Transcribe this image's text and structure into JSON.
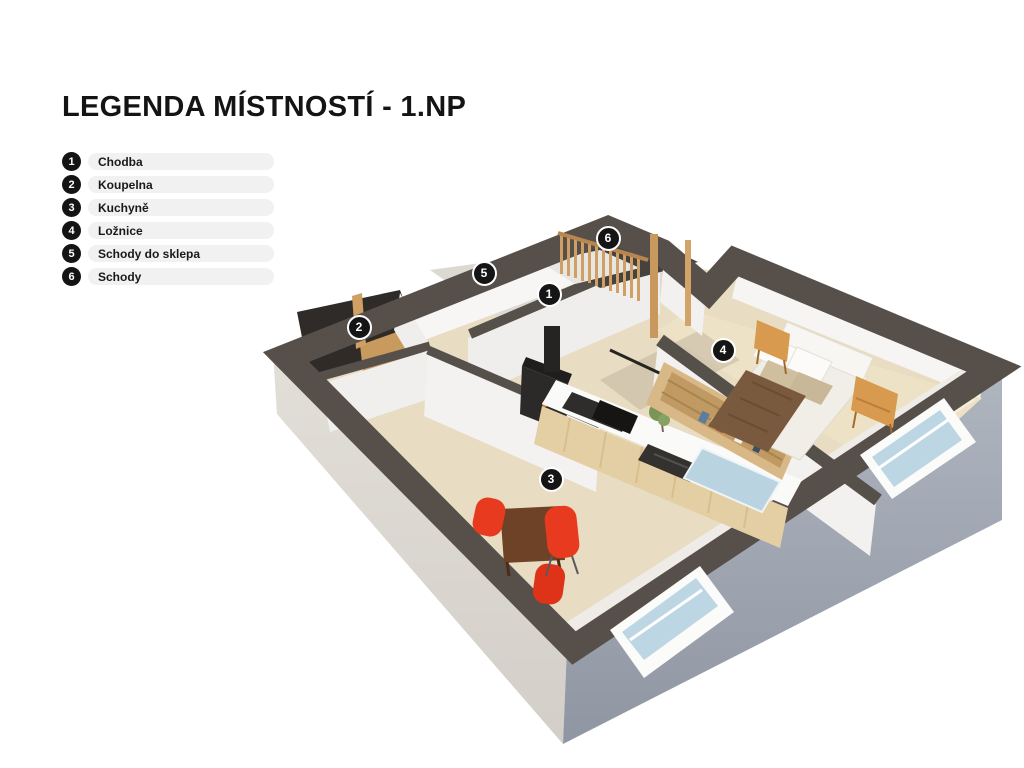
{
  "title": "LEGENDA MÍSTNOSTÍ - 1.NP",
  "legend": {
    "items": [
      {
        "number": "1",
        "label": "Chodba"
      },
      {
        "number": "2",
        "label": "Koupelna"
      },
      {
        "number": "3",
        "label": "Kuchyně"
      },
      {
        "number": "4",
        "label": "Ložnice"
      },
      {
        "number": "5",
        "label": "Schody do sklepa"
      },
      {
        "number": "6",
        "label": "Schody"
      }
    ]
  },
  "floorplan": {
    "markers": [
      {
        "number": "1",
        "label": "Chodba",
        "x": 549,
        "y": 294
      },
      {
        "number": "2",
        "label": "Koupelna",
        "x": 359,
        "y": 327
      },
      {
        "number": "3",
        "label": "Kuchyně",
        "x": 551,
        "y": 479
      },
      {
        "number": "4",
        "label": "Ložnice",
        "x": 723,
        "y": 350
      },
      {
        "number": "5",
        "label": "Schody do sklepa",
        "x": 484,
        "y": 273
      },
      {
        "number": "6",
        "label": "Schody",
        "x": 608,
        "y": 238
      }
    ],
    "palette": {
      "wall_top_band": "#57504a",
      "outer_wall_left": "#dcd8d2",
      "outer_wall_right": "#a2a9b4",
      "inner_wall_white": "#f4f3f1",
      "floor_wood": "#e8dcc2",
      "floor_pale": "#eee2c6",
      "floor_shadow": "#9e968a",
      "wood_partition": "#cf9f63",
      "island_wood": "#e4cfa5",
      "bathroom_dark": "#2e2b29",
      "stove_black": "#2c2a28",
      "bed_linen": "#f1eee7",
      "blanket_brown": "#7a5a3e",
      "pillow_beige": "#cfbf9f",
      "nightstand_orange": "#d89a4f",
      "chair_red": "#e73a1e",
      "table_wood": "#6e4226",
      "glass_blue": "#b9d3e1",
      "plant_green": "#7b9558",
      "marker_bg": "#151515",
      "legend_pill_bg": "#f1f1f1"
    }
  }
}
